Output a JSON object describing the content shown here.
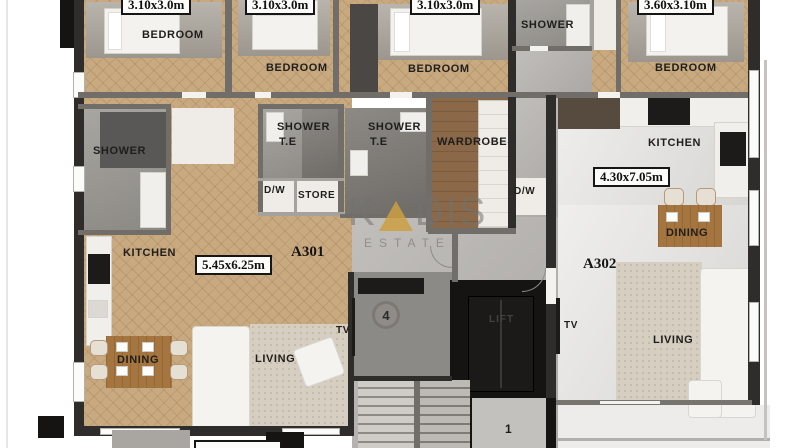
{
  "meta": {
    "type": "architectural-floor-plan",
    "floor_units": [
      "A301",
      "A302"
    ]
  },
  "palette": {
    "wood_floor": "#c9aa80",
    "wall_dark": "#2e2d2b",
    "corridor_concrete": "#b5b2ae",
    "stone_floor": "#dfdedb",
    "wardrobe_brown": "#8a6848",
    "table_brown": "#a5753f",
    "watermark_gray": "#73716d",
    "watermark_gold": "#cda041",
    "label_box_bg": "#fcfcfb",
    "label_text": "#111111"
  },
  "strings": {
    "bedroom": "BEDROOM",
    "shower": "SHOWER",
    "te": "T.E",
    "wardrobe": "WARDROBE",
    "store": "STORE",
    "kitchen": "KITCHEN",
    "dining": "DINING",
    "living": "LIVING",
    "dw": "D/W",
    "tv": "TV",
    "lift": "LIFT"
  },
  "dimensions": {
    "a301_bedroom1": "3.10x3.0m",
    "a301_bedroom2": "3.10x3.0m",
    "a301_bedroom3": "3.10x3.0m",
    "a302_bedroom": "3.60x3.10m",
    "a301_living": "5.45x6.25m",
    "a302_living": "4.30x7.05m"
  },
  "units": {
    "a301": "A301",
    "a302": "A302"
  },
  "markers": {
    "stair_core": "4",
    "landing": "1"
  },
  "watermark": {
    "k": "K",
    "dis": "DIS",
    "sub": "ESTATES"
  }
}
